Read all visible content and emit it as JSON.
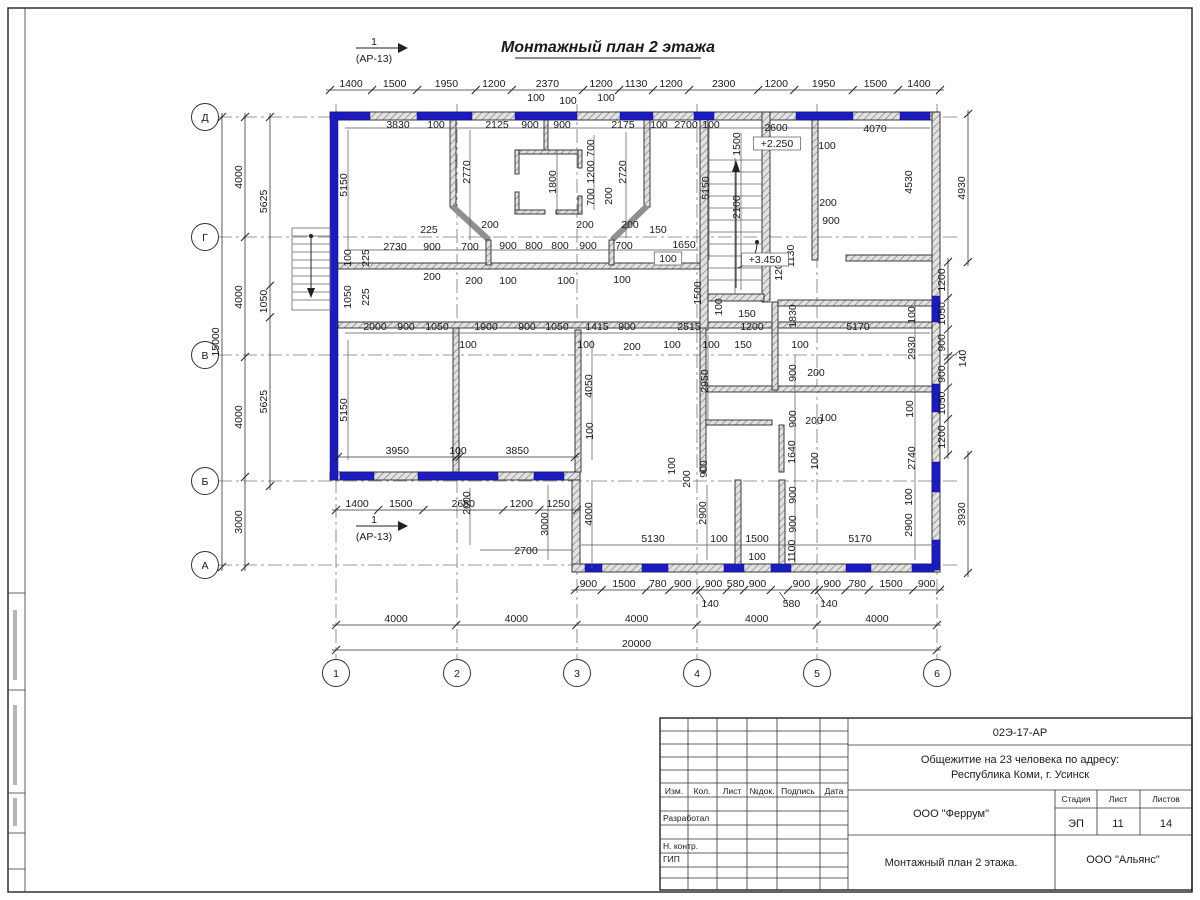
{
  "title": {
    "text": "Монтажный план 2 этажа"
  },
  "colors": {
    "window_blue": "#1b1bbe",
    "wall_gray": "#8f8f8f"
  },
  "section_marker": {
    "number": "1",
    "reference": "(АР-13)"
  },
  "axes": {
    "rows": [
      {
        "label": "Д",
        "y": 117
      },
      {
        "label": "Г",
        "y": 237
      },
      {
        "label": "В",
        "y": 355
      },
      {
        "label": "Б",
        "y": 481
      },
      {
        "label": "А",
        "y": 565
      }
    ],
    "cols": [
      {
        "label": "1",
        "x": 336
      },
      {
        "label": "2",
        "x": 457
      },
      {
        "label": "3",
        "x": 577
      },
      {
        "label": "4",
        "x": 697
      },
      {
        "label": "5",
        "x": 817
      },
      {
        "label": "6",
        "x": 937
      }
    ]
  },
  "chains": [
    {
      "o": "h",
      "y": 90,
      "x0": 330,
      "x1": 940,
      "values": [
        1400,
        1500,
        1950,
        1200,
        2370,
        1200,
        1130,
        1200,
        2300,
        1200,
        1950,
        1500,
        1400
      ]
    },
    {
      "o": "h",
      "y": 590,
      "x0": 575,
      "x1": 940,
      "values": [
        900,
        1500,
        780,
        900,
        {
          "v": 140,
          "leader": true
        },
        900,
        580,
        900,
        {
          "v": 580,
          "leader": true
        },
        900,
        {
          "v": 140,
          "leader": true
        },
        900,
        780,
        1500,
        900
      ]
    },
    {
      "o": "h",
      "y": 625,
      "x0": 336,
      "x1": 937,
      "values": [
        4000,
        4000,
        4000,
        4000,
        4000
      ]
    },
    {
      "o": "h",
      "y": 650,
      "x0": 336,
      "x1": 937,
      "values": [
        20000
      ]
    },
    {
      "o": "h",
      "y": 510,
      "x0": 336,
      "x1": 577,
      "values": [
        1400,
        1500,
        2650,
        1200,
        1250
      ]
    },
    {
      "o": "h",
      "y": 457,
      "x0": 338,
      "x1": 575,
      "values": [
        3950,
        100,
        3850
      ]
    },
    {
      "o": "v",
      "x": 270,
      "y0": 117,
      "y1": 486,
      "values": [
        5625,
        1050,
        5625
      ]
    },
    {
      "o": "v",
      "x": 245,
      "y0": 117,
      "y1": 567,
      "values": [
        4000,
        4000,
        4000,
        3000
      ]
    },
    {
      "o": "v",
      "x": 222,
      "y0": 117,
      "y1": 567,
      "values": [
        15000
      ]
    },
    {
      "o": "v",
      "x": 948,
      "y0": 262,
      "y1": 455,
      "values": [
        1200,
        1050,
        900,
        {
          "v": 140,
          "leader": true
        },
        900,
        1050,
        1200
      ]
    },
    {
      "o": "v",
      "x": 968,
      "y0": 114,
      "y1": 262,
      "values": [
        4930
      ]
    },
    {
      "o": "v",
      "x": 968,
      "y0": 455,
      "y1": 573,
      "values": [
        3930
      ]
    }
  ],
  "labels": [
    {
      "t": "1",
      "x": 374,
      "y": 45,
      "fs": 12
    },
    {
      "t": "(АР-13)",
      "x": 374,
      "y": 62,
      "fs": 11
    },
    {
      "t": "1",
      "x": 374,
      "y": 523,
      "fs": 12
    },
    {
      "t": "(АР-13)",
      "x": 374,
      "y": 540,
      "fs": 11
    },
    {
      "t": "100",
      "x": 536,
      "y": 101
    },
    {
      "t": "100",
      "x": 568,
      "y": 104
    },
    {
      "t": "100",
      "x": 606,
      "y": 101
    },
    {
      "t": "3830",
      "x": 398,
      "y": 128
    },
    {
      "t": "100",
      "x": 436,
      "y": 128
    },
    {
      "t": "2125",
      "x": 497,
      "y": 128
    },
    {
      "t": "900",
      "x": 530,
      "y": 128
    },
    {
      "t": "900",
      "x": 562,
      "y": 128
    },
    {
      "t": "2175",
      "x": 623,
      "y": 128
    },
    {
      "t": "100",
      "x": 659,
      "y": 128
    },
    {
      "t": "2700",
      "x": 686,
      "y": 128
    },
    {
      "t": "100",
      "x": 711,
      "y": 128
    },
    {
      "t": "2600",
      "x": 776,
      "y": 131
    },
    {
      "t": "4070",
      "x": 875,
      "y": 132
    },
    {
      "t": "5150",
      "x": 347,
      "y": 185,
      "r": -90
    },
    {
      "t": "2770",
      "x": 470,
      "y": 172,
      "r": -90
    },
    {
      "t": "1800",
      "x": 556,
      "y": 182,
      "r": -90
    },
    {
      "t": "700",
      "x": 594,
      "y": 148,
      "r": -90
    },
    {
      "t": "1200",
      "x": 594,
      "y": 172,
      "r": -90
    },
    {
      "t": "700",
      "x": 594,
      "y": 197,
      "r": -90
    },
    {
      "t": "200",
      "x": 612,
      "y": 196,
      "r": -90
    },
    {
      "t": "2720",
      "x": 626,
      "y": 172,
      "r": -90
    },
    {
      "t": "5150",
      "x": 709,
      "y": 188,
      "r": -90
    },
    {
      "t": "1500",
      "x": 740,
      "y": 144,
      "r": -90
    },
    {
      "t": "2100",
      "x": 740,
      "y": 207,
      "r": -90
    },
    {
      "t": "4530",
      "x": 912,
      "y": 182,
      "r": -90
    },
    {
      "t": "1130",
      "x": 794,
      "y": 256,
      "r": -90
    },
    {
      "t": "1200",
      "x": 782,
      "y": 269,
      "r": -90
    },
    {
      "t": "100",
      "x": 827,
      "y": 149
    },
    {
      "t": "200",
      "x": 828,
      "y": 206
    },
    {
      "t": "900",
      "x": 831,
      "y": 224
    },
    {
      "t": "+2.250",
      "x": 777,
      "y": 147,
      "b": true
    },
    {
      "t": "+3.450",
      "x": 765,
      "y": 263,
      "b": true
    },
    {
      "t": "2730",
      "x": 395,
      "y": 250
    },
    {
      "t": "900",
      "x": 432,
      "y": 250
    },
    {
      "t": "700",
      "x": 470,
      "y": 250
    },
    {
      "t": "900",
      "x": 508,
      "y": 249
    },
    {
      "t": "800",
      "x": 534,
      "y": 249
    },
    {
      "t": "800",
      "x": 560,
      "y": 249
    },
    {
      "t": "900",
      "x": 588,
      "y": 249
    },
    {
      "t": "700",
      "x": 624,
      "y": 249
    },
    {
      "t": "150",
      "x": 658,
      "y": 233
    },
    {
      "t": "1650",
      "x": 684,
      "y": 248
    },
    {
      "t": "100",
      "x": 668,
      "y": 262,
      "b": true
    },
    {
      "t": "225",
      "x": 429,
      "y": 233
    },
    {
      "t": "200",
      "x": 490,
      "y": 228
    },
    {
      "t": "200",
      "x": 585,
      "y": 228
    },
    {
      "t": "200",
      "x": 630,
      "y": 228
    },
    {
      "t": "200",
      "x": 432,
      "y": 280
    },
    {
      "t": "200",
      "x": 474,
      "y": 284
    },
    {
      "t": "100",
      "x": 508,
      "y": 284
    },
    {
      "t": "100",
      "x": 566,
      "y": 284
    },
    {
      "t": "100",
      "x": 622,
      "y": 283
    },
    {
      "t": "100",
      "x": 351,
      "y": 258,
      "r": -90
    },
    {
      "t": "225",
      "x": 369,
      "y": 258,
      "r": -90
    },
    {
      "t": "1050",
      "x": 351,
      "y": 297,
      "r": -90
    },
    {
      "t": "225",
      "x": 369,
      "y": 297,
      "r": -90
    },
    {
      "t": "2000",
      "x": 375,
      "y": 330
    },
    {
      "t": "900",
      "x": 406,
      "y": 330
    },
    {
      "t": "1050",
      "x": 437,
      "y": 330
    },
    {
      "t": "1900",
      "x": 486,
      "y": 330
    },
    {
      "t": "900",
      "x": 527,
      "y": 330
    },
    {
      "t": "1050",
      "x": 557,
      "y": 330
    },
    {
      "t": "1415",
      "x": 597,
      "y": 330
    },
    {
      "t": "900",
      "x": 627,
      "y": 330
    },
    {
      "t": "2515",
      "x": 689,
      "y": 330
    },
    {
      "t": "1200",
      "x": 752,
      "y": 330
    },
    {
      "t": "5170",
      "x": 858,
      "y": 330
    },
    {
      "t": "150",
      "x": 747,
      "y": 317
    },
    {
      "t": "150",
      "x": 743,
      "y": 348
    },
    {
      "t": "1830",
      "x": 796,
      "y": 316,
      "r": -90
    },
    {
      "t": "100",
      "x": 468,
      "y": 348
    },
    {
      "t": "100",
      "x": 586,
      "y": 348
    },
    {
      "t": "100",
      "x": 672,
      "y": 348
    },
    {
      "t": "100",
      "x": 711,
      "y": 348
    },
    {
      "t": "100",
      "x": 800,
      "y": 348
    },
    {
      "t": "200",
      "x": 632,
      "y": 350
    },
    {
      "t": "2930",
      "x": 915,
      "y": 348,
      "r": -90
    },
    {
      "t": "100",
      "x": 915,
      "y": 315,
      "r": -90
    },
    {
      "t": "1500",
      "x": 701,
      "y": 293,
      "r": -90
    },
    {
      "t": "100",
      "x": 722,
      "y": 307,
      "r": -90
    },
    {
      "t": "4050",
      "x": 592,
      "y": 386,
      "r": -90
    },
    {
      "t": "5150",
      "x": 347,
      "y": 410,
      "r": -90
    },
    {
      "t": "2950",
      "x": 708,
      "y": 381,
      "r": -90
    },
    {
      "t": "900",
      "x": 796,
      "y": 373,
      "r": -90
    },
    {
      "t": "200",
      "x": 816,
      "y": 376
    },
    {
      "t": "900",
      "x": 796,
      "y": 419,
      "r": -90
    },
    {
      "t": "200",
      "x": 814,
      "y": 424
    },
    {
      "t": "100",
      "x": 828,
      "y": 421
    },
    {
      "t": "1640",
      "x": 795,
      "y": 452,
      "r": -90
    },
    {
      "t": "100",
      "x": 818,
      "y": 461,
      "r": -90
    },
    {
      "t": "2740",
      "x": 915,
      "y": 458,
      "r": -90
    },
    {
      "t": "100",
      "x": 913,
      "y": 409,
      "r": -90
    },
    {
      "t": "100",
      "x": 593,
      "y": 431,
      "r": -90
    },
    {
      "t": "2000",
      "x": 470,
      "y": 503,
      "r": -90
    },
    {
      "t": "3000",
      "x": 548,
      "y": 524,
      "r": -90
    },
    {
      "t": "2700",
      "x": 526,
      "y": 554
    },
    {
      "t": "4000",
      "x": 592,
      "y": 514,
      "r": -90
    },
    {
      "t": "5130",
      "x": 653,
      "y": 542
    },
    {
      "t": "100",
      "x": 719,
      "y": 542
    },
    {
      "t": "1500",
      "x": 757,
      "y": 542
    },
    {
      "t": "100",
      "x": 757,
      "y": 560
    },
    {
      "t": "100",
      "x": 675,
      "y": 466,
      "r": -90
    },
    {
      "t": "200",
      "x": 690,
      "y": 479,
      "r": -90
    },
    {
      "t": "900",
      "x": 707,
      "y": 469,
      "r": -90
    },
    {
      "t": "2900",
      "x": 706,
      "y": 513,
      "r": -90
    },
    {
      "t": "5170",
      "x": 860,
      "y": 542
    },
    {
      "t": "900",
      "x": 796,
      "y": 495,
      "r": -90
    },
    {
      "t": "900",
      "x": 796,
      "y": 524,
      "r": -90
    },
    {
      "t": "1100",
      "x": 795,
      "y": 551,
      "r": -90
    },
    {
      "t": "100",
      "x": 912,
      "y": 497,
      "r": -90
    },
    {
      "t": "2900",
      "x": 912,
      "y": 525,
      "r": -90
    }
  ],
  "title_block": {
    "doc_number": "02Э-17-АР",
    "project_line1": "Общежитие на 23 человека по адресу:",
    "project_line2": "Республика Коми, г. Усинск",
    "designer_org": "ООО \"Феррум\"",
    "contractor_org": "ООО \"Альянс\"",
    "sheet_title": "Монтажный план 2 этажа.",
    "stage_label": "Стадия",
    "sheet_label": "Лист",
    "sheets_label": "Листов",
    "stage": "ЭП",
    "sheet": "11",
    "sheets": "14",
    "header_cols": [
      "Изм.",
      "Кол.",
      "Лист",
      "№док.",
      "Подпись",
      "Дата"
    ],
    "row_labels": [
      "Разработал",
      "Н. контр.",
      "ГИП"
    ]
  }
}
